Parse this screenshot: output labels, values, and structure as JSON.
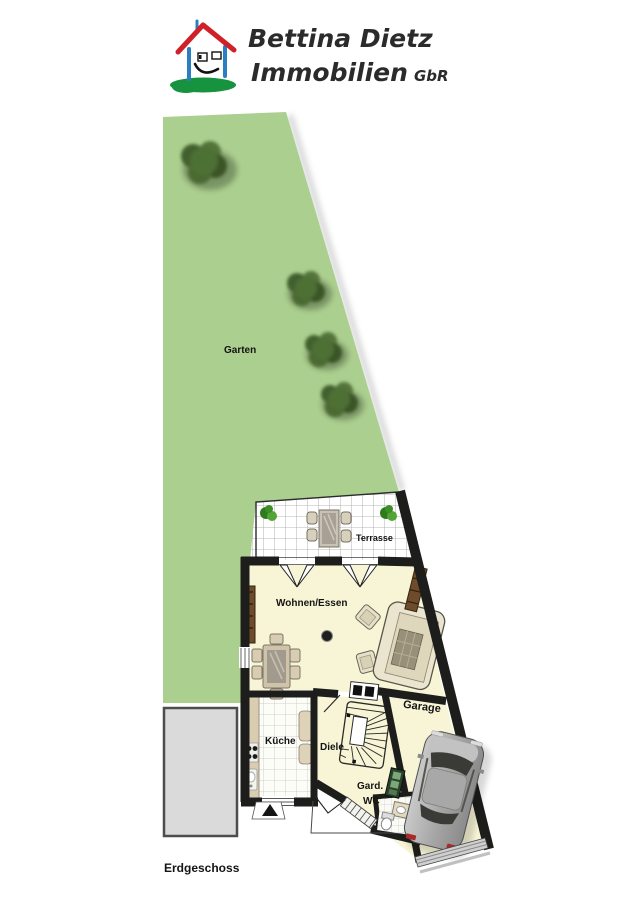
{
  "logo": {
    "name_line": "Bettina Dietz",
    "business_line": "Immobilien",
    "suffix": "GbR"
  },
  "labels": {
    "garden": "Garten",
    "terrace": "Terrasse",
    "living_dining": "Wohnen/Essen",
    "kitchen": "Küche",
    "hallway": "Diele",
    "wardrobe": "Gard.",
    "wc": "WC",
    "garage": "Garage"
  },
  "floor_label": "Erdgeschoss",
  "colors": {
    "garden_green": "#abcf8e",
    "bush_green": "#4a6a34",
    "floor_cream": "#f8f5d6",
    "wall_dark": "#1d1d1b",
    "driveway_gray": "#dadada",
    "logo_roof_red": "#d02028",
    "logo_wall_blue": "#2a7fc1",
    "logo_ground_green": "#17933f"
  }
}
